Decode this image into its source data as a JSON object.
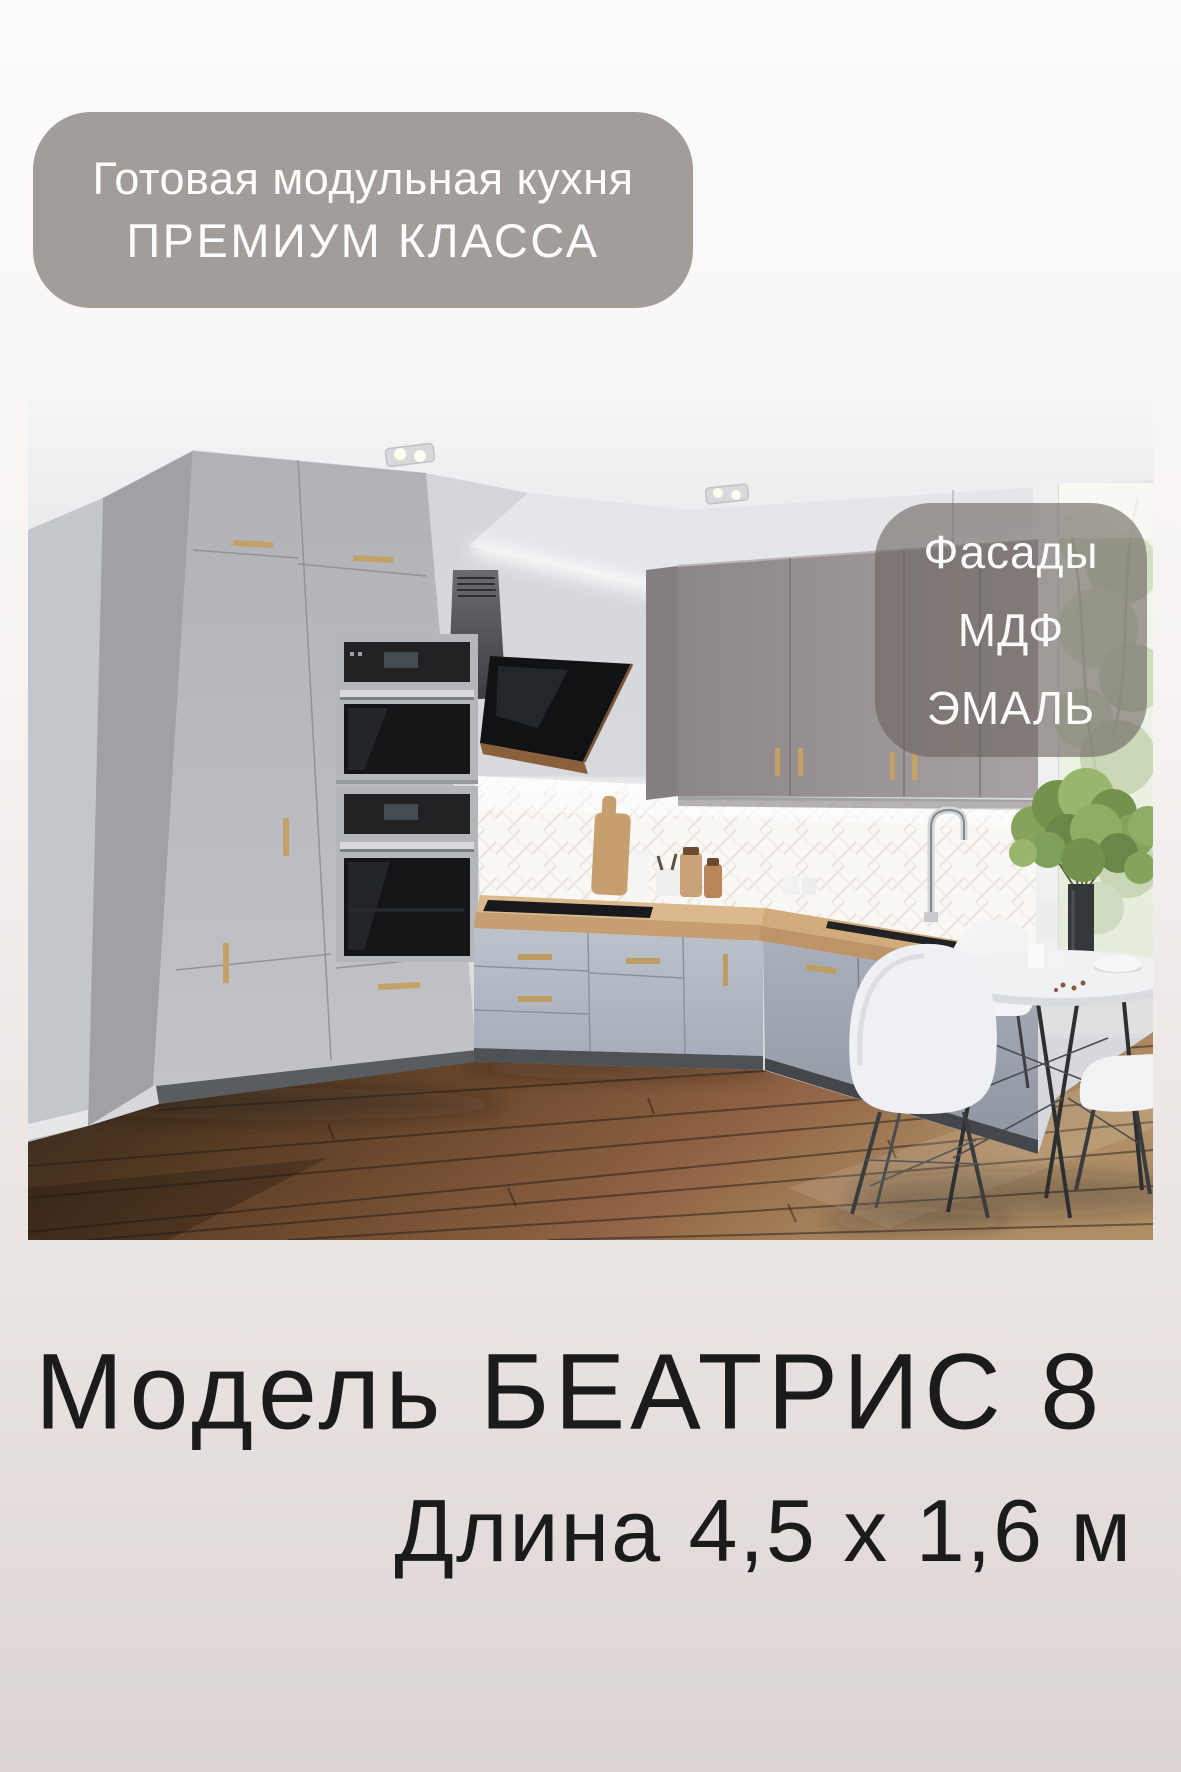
{
  "card": {
    "background_gradient_top": "#fbfafa",
    "background_gradient_bottom": "#dcd5d3"
  },
  "top_badge": {
    "line1": "Готовая модульная кухня",
    "line2": "ПРЕМИУМ КЛАССА",
    "background_color": "#a29d99",
    "text_color": "#ffffff"
  },
  "facade_badge": {
    "line1": "Фасады",
    "line2": "МДФ",
    "line3": "ЭМАЛЬ",
    "background_color": "rgba(104,97,92,0.6)",
    "text_color": "#ffffff"
  },
  "title": {
    "model_line": "Модель БЕАТРИС 8",
    "dimensions_line": "Длина 4,5 х 1,6 м",
    "text_color": "#1b1b1b"
  }
}
